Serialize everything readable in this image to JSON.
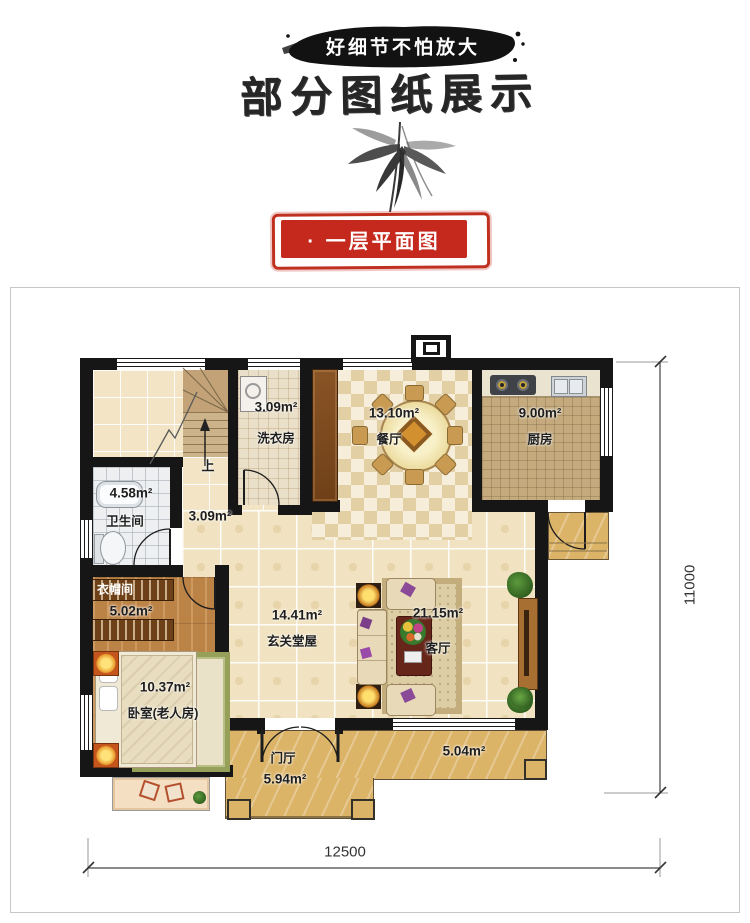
{
  "header": {
    "banner_text": "好细节不怕放大",
    "title": "部分图纸展示",
    "seal_label": "· 一层平面图"
  },
  "plan": {
    "stairs_up_label": "上",
    "rooms": [
      {
        "name": "洗衣房",
        "area": "3.09m²"
      },
      {
        "name": "餐厅",
        "area": "13.10m²"
      },
      {
        "name": "厨房",
        "area": "9.00m²"
      },
      {
        "name": "卫生间",
        "area": "4.58m²"
      },
      {
        "name": "",
        "area": "3.09m²"
      },
      {
        "name": "衣帽间",
        "area": "5.02m²"
      },
      {
        "name": "玄关堂屋",
        "area": "14.41m²"
      },
      {
        "name": "客厅",
        "area": "21.15m²"
      },
      {
        "name": "卧室(老人房)",
        "area": "10.37m²"
      },
      {
        "name": "门厅",
        "area": "5.94m²"
      },
      {
        "name": "",
        "area": "5.04m²"
      }
    ],
    "dimensions": {
      "bottom": "12500",
      "right": "11000"
    }
  },
  "colors": {
    "seal_red": "#c5281c",
    "ink_black": "#161616",
    "tile_beige": "#f1e3c2",
    "wood_brown": "#bc8347",
    "marble_gold": "#dcb468"
  }
}
